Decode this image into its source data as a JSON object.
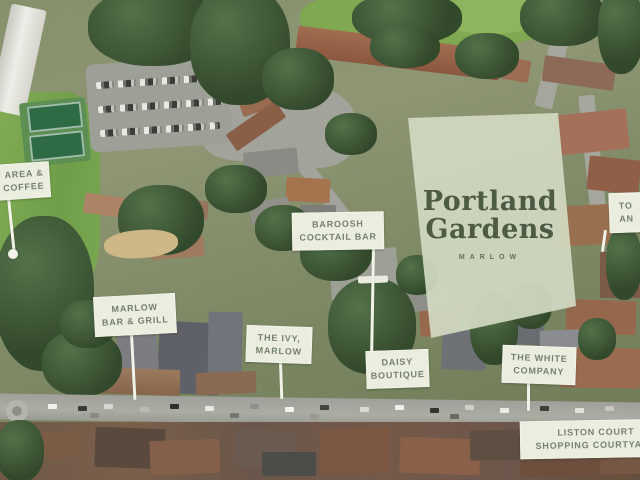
{
  "site_overlay": {
    "line1": "Portland",
    "line2": "Gardens",
    "subtitle": "MARLOW",
    "fill_color": "#d1d9c2",
    "text_color": "#4d5a44"
  },
  "map_labels": {
    "area_coffee": {
      "line1": "AREA &",
      "line2": "COFFEE"
    },
    "baroosh": {
      "line1": "BAROOSH",
      "line2": "COCKTAIL BAR"
    },
    "marlow_bar_grill": {
      "line1": "MARLOW",
      "line2": "BAR & GRILL"
    },
    "the_ivy": {
      "line1": "THE IVY,",
      "line2": "MARLOW"
    },
    "daisy_boutique": {
      "line1": "DAISY",
      "line2": "BOUTIQUE"
    },
    "white_company": {
      "line1": "THE WHITE",
      "line2": "COMPANY"
    },
    "liston_court": {
      "line1": "LISTON COURT",
      "line2": "SHOPPING COURTYARD"
    },
    "to_an": {
      "line1": "TO",
      "line2": "AN"
    }
  },
  "label_style_colors": {
    "background": "#ebeede",
    "text": "#75826d",
    "pointer_line": "#f2f3e8"
  }
}
